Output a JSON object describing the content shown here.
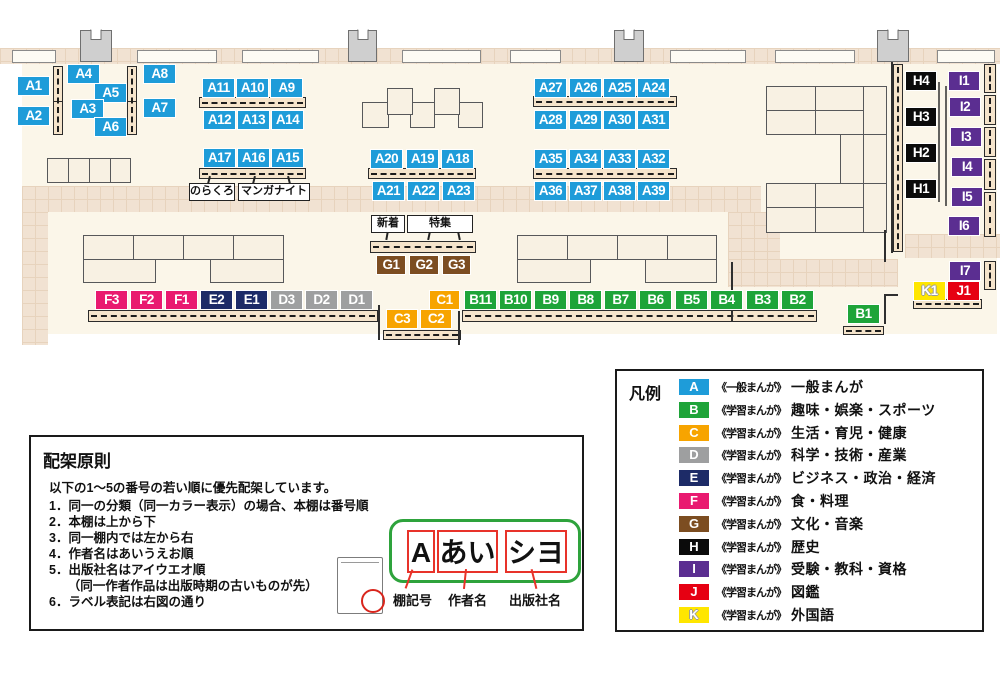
{
  "map": {
    "annotations": {
      "norakuro": "のらくろ",
      "manga_night": "マンガナイト",
      "new_arrivals": "新着",
      "special_feature": "特集"
    },
    "shelves": [
      {
        "label": "A1",
        "cat": "A",
        "x": 17,
        "y": 76
      },
      {
        "label": "A2",
        "cat": "A",
        "x": 17,
        "y": 106
      },
      {
        "label": "A4",
        "cat": "A",
        "x": 67,
        "y": 64
      },
      {
        "label": "A5",
        "cat": "A",
        "x": 94,
        "y": 83
      },
      {
        "label": "A3",
        "cat": "A",
        "x": 71,
        "y": 99
      },
      {
        "label": "A6",
        "cat": "A",
        "x": 94,
        "y": 117
      },
      {
        "label": "A8",
        "cat": "A",
        "x": 143,
        "y": 64
      },
      {
        "label": "A7",
        "cat": "A",
        "x": 143,
        "y": 98
      },
      {
        "label": "A11",
        "cat": "A",
        "x": 202,
        "y": 78
      },
      {
        "label": "A10",
        "cat": "A",
        "x": 236,
        "y": 78
      },
      {
        "label": "A9",
        "cat": "A",
        "x": 270,
        "y": 78
      },
      {
        "label": "A12",
        "cat": "A",
        "x": 203,
        "y": 110
      },
      {
        "label": "A13",
        "cat": "A",
        "x": 237,
        "y": 110
      },
      {
        "label": "A14",
        "cat": "A",
        "x": 271,
        "y": 110
      },
      {
        "label": "A17",
        "cat": "A",
        "x": 203,
        "y": 148
      },
      {
        "label": "A16",
        "cat": "A",
        "x": 237,
        "y": 148
      },
      {
        "label": "A15",
        "cat": "A",
        "x": 271,
        "y": 148
      },
      {
        "label": "A20",
        "cat": "A",
        "x": 370,
        "y": 149
      },
      {
        "label": "A19",
        "cat": "A",
        "x": 406,
        "y": 149
      },
      {
        "label": "A18",
        "cat": "A",
        "x": 441,
        "y": 149
      },
      {
        "label": "A21",
        "cat": "A",
        "x": 372,
        "y": 181
      },
      {
        "label": "A22",
        "cat": "A",
        "x": 407,
        "y": 181
      },
      {
        "label": "A23",
        "cat": "A",
        "x": 442,
        "y": 181
      },
      {
        "label": "A27",
        "cat": "A",
        "x": 534,
        "y": 78
      },
      {
        "label": "A26",
        "cat": "A",
        "x": 569,
        "y": 78
      },
      {
        "label": "A25",
        "cat": "A",
        "x": 603,
        "y": 78
      },
      {
        "label": "A24",
        "cat": "A",
        "x": 637,
        "y": 78
      },
      {
        "label": "A28",
        "cat": "A",
        "x": 534,
        "y": 110
      },
      {
        "label": "A29",
        "cat": "A",
        "x": 569,
        "y": 110
      },
      {
        "label": "A30",
        "cat": "A",
        "x": 603,
        "y": 110
      },
      {
        "label": "A31",
        "cat": "A",
        "x": 637,
        "y": 110
      },
      {
        "label": "A35",
        "cat": "A",
        "x": 534,
        "y": 149
      },
      {
        "label": "A34",
        "cat": "A",
        "x": 569,
        "y": 149
      },
      {
        "label": "A33",
        "cat": "A",
        "x": 603,
        "y": 149
      },
      {
        "label": "A32",
        "cat": "A",
        "x": 637,
        "y": 149
      },
      {
        "label": "A36",
        "cat": "A",
        "x": 534,
        "y": 181
      },
      {
        "label": "A37",
        "cat": "A",
        "x": 569,
        "y": 181
      },
      {
        "label": "A38",
        "cat": "A",
        "x": 603,
        "y": 181
      },
      {
        "label": "A39",
        "cat": "A",
        "x": 637,
        "y": 181
      },
      {
        "label": "G1",
        "cat": "G",
        "x": 376,
        "y": 255,
        "w": 30
      },
      {
        "label": "G2",
        "cat": "G",
        "x": 409,
        "y": 255,
        "w": 30
      },
      {
        "label": "G3",
        "cat": "G",
        "x": 442,
        "y": 255,
        "w": 29
      },
      {
        "label": "F3",
        "cat": "F",
        "x": 95,
        "y": 290
      },
      {
        "label": "F2",
        "cat": "F",
        "x": 130,
        "y": 290
      },
      {
        "label": "F1",
        "cat": "F",
        "x": 165,
        "y": 290
      },
      {
        "label": "E2",
        "cat": "E",
        "x": 200,
        "y": 290
      },
      {
        "label": "E1",
        "cat": "E",
        "x": 235,
        "y": 290
      },
      {
        "label": "D3",
        "cat": "D",
        "x": 270,
        "y": 290
      },
      {
        "label": "D2",
        "cat": "D",
        "x": 305,
        "y": 290
      },
      {
        "label": "D1",
        "cat": "D",
        "x": 340,
        "y": 290
      },
      {
        "label": "C1",
        "cat": "C",
        "x": 429,
        "y": 290,
        "w": 31
      },
      {
        "label": "B11",
        "cat": "B",
        "x": 464,
        "y": 290
      },
      {
        "label": "B10",
        "cat": "B",
        "x": 499,
        "y": 290
      },
      {
        "label": "B9",
        "cat": "B",
        "x": 534,
        "y": 290
      },
      {
        "label": "B8",
        "cat": "B",
        "x": 569,
        "y": 290
      },
      {
        "label": "B7",
        "cat": "B",
        "x": 604,
        "y": 290
      },
      {
        "label": "B6",
        "cat": "B",
        "x": 639,
        "y": 290
      },
      {
        "label": "B5",
        "cat": "B",
        "x": 675,
        "y": 290
      },
      {
        "label": "B4",
        "cat": "B",
        "x": 710,
        "y": 290
      },
      {
        "label": "B3",
        "cat": "B",
        "x": 746,
        "y": 290
      },
      {
        "label": "B2",
        "cat": "B",
        "x": 781,
        "y": 290
      },
      {
        "label": "C3",
        "cat": "C",
        "x": 386,
        "y": 309,
        "w": 32
      },
      {
        "label": "C2",
        "cat": "C",
        "x": 420,
        "y": 309,
        "w": 32
      },
      {
        "label": "B1",
        "cat": "B",
        "x": 847,
        "y": 304
      },
      {
        "label": "H4",
        "cat": "H",
        "x": 905,
        "y": 71,
        "w": 32
      },
      {
        "label": "H3",
        "cat": "H",
        "x": 905,
        "y": 107,
        "w": 32
      },
      {
        "label": "H2",
        "cat": "H",
        "x": 905,
        "y": 143,
        "w": 32
      },
      {
        "label": "H1",
        "cat": "H",
        "x": 905,
        "y": 179,
        "w": 32
      },
      {
        "label": "I1",
        "cat": "I",
        "x": 948,
        "y": 71,
        "w": 32
      },
      {
        "label": "I2",
        "cat": "I",
        "x": 949,
        "y": 97,
        "w": 32
      },
      {
        "label": "I3",
        "cat": "I",
        "x": 950,
        "y": 127,
        "w": 32
      },
      {
        "label": "I4",
        "cat": "I",
        "x": 951,
        "y": 157,
        "w": 32
      },
      {
        "label": "I5",
        "cat": "I",
        "x": 951,
        "y": 187,
        "w": 32
      },
      {
        "label": "I6",
        "cat": "I",
        "x": 948,
        "y": 216,
        "w": 32
      },
      {
        "label": "I7",
        "cat": "I",
        "x": 949,
        "y": 261,
        "w": 32
      },
      {
        "label": "K1",
        "cat": "K",
        "x": 913,
        "y": 281
      },
      {
        "label": "J1",
        "cat": "J",
        "x": 947,
        "y": 281
      }
    ]
  },
  "legend": {
    "title": "凡例",
    "items": [
      {
        "code": "A",
        "color": "#1E9CD9",
        "series": "《一般まんが》",
        "category": "一般まんが"
      },
      {
        "code": "B",
        "color": "#1EA439",
        "series": "《学習まんが》",
        "category": "趣味・娯楽・スポーツ"
      },
      {
        "code": "C",
        "color": "#F7A400",
        "series": "《学習まんが》",
        "category": "生活・育児・健康"
      },
      {
        "code": "D",
        "color": "#9E9FA0",
        "series": "《学習まんが》",
        "category": "科学・技術・産業"
      },
      {
        "code": "E",
        "color": "#1D2B67",
        "series": "《学習まんが》",
        "category": "ビジネス・政治・経済"
      },
      {
        "code": "F",
        "color": "#E91A70",
        "series": "《学習まんが》",
        "category": "食・料理"
      },
      {
        "code": "G",
        "color": "#7C4D21",
        "series": "《学習まんが》",
        "category": "文化・音楽"
      },
      {
        "code": "H",
        "color": "#0B0B0B",
        "series": "《学習まんが》",
        "category": "歴史"
      },
      {
        "code": "I",
        "color": "#5B2E91",
        "series": "《学習まんが》",
        "category": "受験・教科・資格"
      },
      {
        "code": "J",
        "color": "#E60012",
        "series": "《学習まんが》",
        "category": "図鑑"
      },
      {
        "code": "K",
        "color": "#FFE600",
        "series": "《学習まんが》",
        "category": "外国語"
      }
    ]
  },
  "principles": {
    "title": "配架原則",
    "intro": "以下の1～5の番号の若い順に優先配架しています。",
    "items": [
      "1．同一の分類（同一カラー表示）の場合、本棚は番号順",
      "2．本棚は上から下",
      "3．同一棚内では左から右",
      "4．作者名はあいうえお順",
      "5．出版社名はアイウエオ順",
      "　　（同一作者作品は出版時期の古いものが先）",
      "6．ラベル表記は右図の通り"
    ]
  },
  "label_diagram": {
    "shelf_code": "A",
    "author": "あい",
    "publisher": "シヨ",
    "captions": [
      "棚記号",
      "作者名",
      "出版社名"
    ]
  }
}
